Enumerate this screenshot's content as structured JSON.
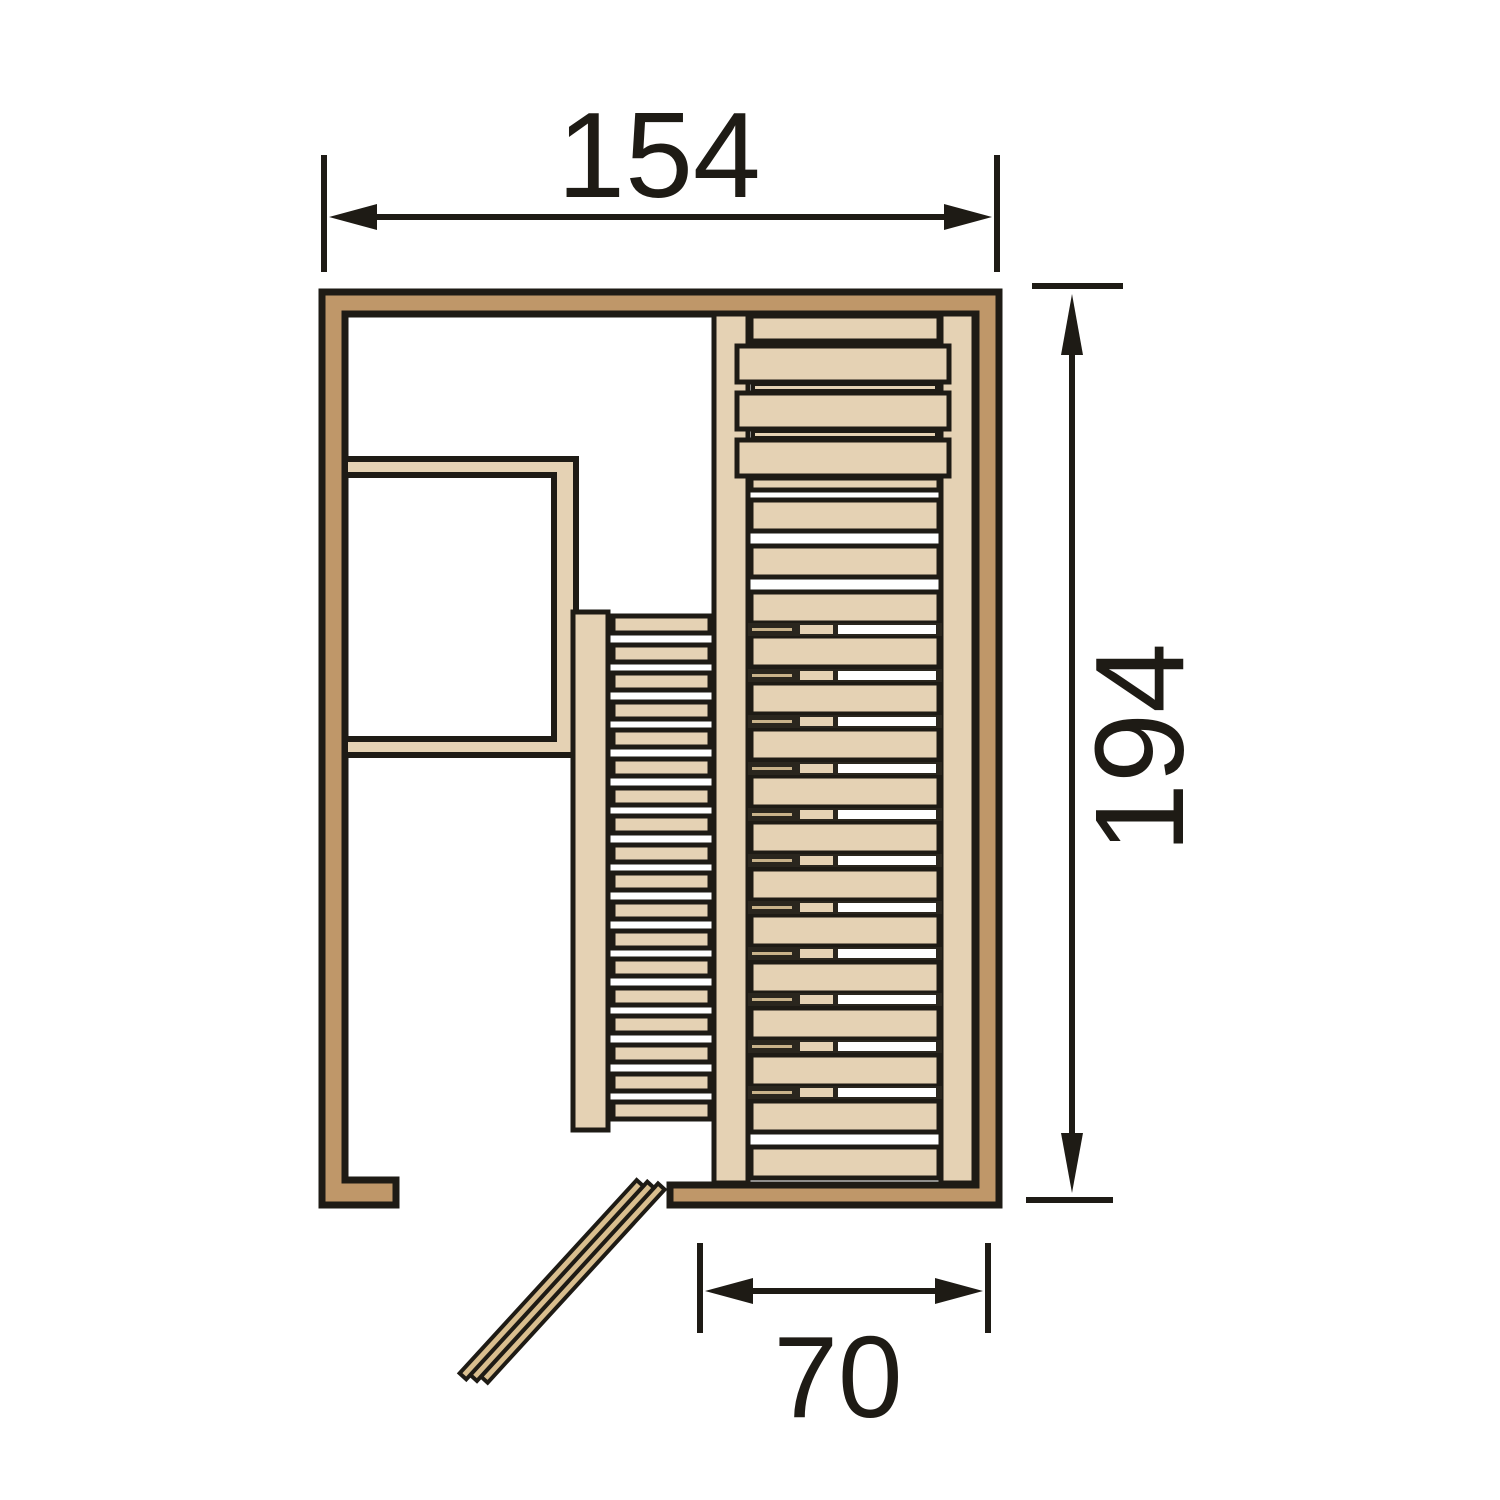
{
  "diagram": {
    "kind": "sauna-floor-plan",
    "dimensions": {
      "width_label": "154",
      "height_label": "194",
      "door_label": "70"
    }
  },
  "colors": {
    "background": "#FFFFFF",
    "wall": "#BF9769",
    "wood": "#E5D2B4",
    "door_wood": "#D9BE8E",
    "line": "#1E1B15",
    "gap_dark": "#2A261E",
    "gap_accent": "#C8B28A"
  }
}
